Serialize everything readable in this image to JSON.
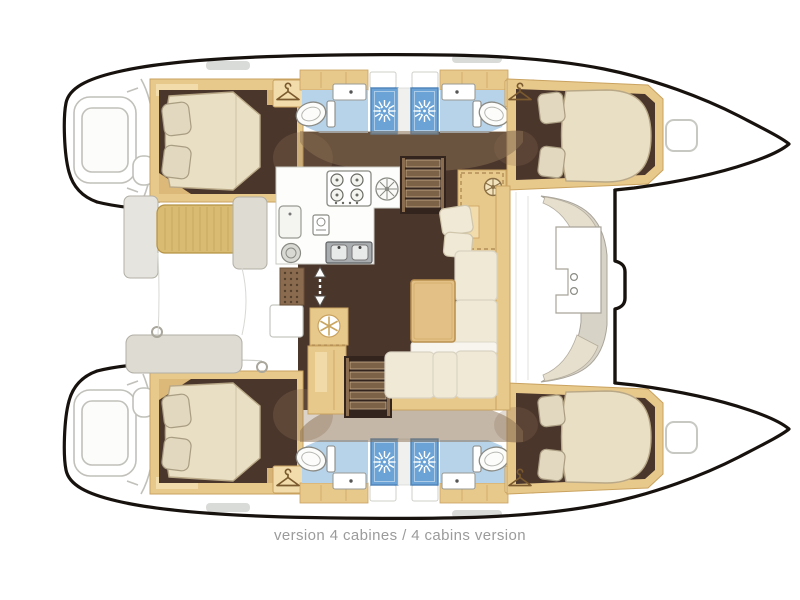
{
  "caption": "version 4 cabines / 4 cabins version",
  "plan": {
    "type": "catamaran-interior-floor-plan",
    "layout_version": "4 cabins",
    "hulls": [
      {
        "name": "port-hull",
        "rooms": [
          "aft-double-cabin",
          "aft-head-toilet-sink",
          "aft-shower",
          "fore-shower",
          "fore-head-toilet-sink",
          "fore-double-cabin"
        ]
      },
      {
        "name": "starboard-hull",
        "rooms": [
          "aft-double-cabin",
          "aft-head-toilet-sink",
          "aft-shower",
          "fore-shower",
          "fore-head-toilet-sink",
          "fore-double-cabin"
        ]
      }
    ],
    "salon": [
      "galley-counter",
      "stove-4-burners",
      "double-sink",
      "oven",
      "refrigerator-freezer",
      "companionway-stairs-port",
      "companionway-stairs-starboard",
      "chart-table",
      "dinette-sofa",
      "dinette-table",
      "entry-mat",
      "sliding-door-arrow"
    ],
    "exterior": [
      "transom-steps",
      "aft-cockpit-benches",
      "forward-cockpit-bench",
      "bow-deck-hatches"
    ]
  },
  "icons": [
    "shower-sunburst-icon",
    "clothes-hanger-icon",
    "stove-burners-icon",
    "vent-fan-icon",
    "snowflake-fridge-icon",
    "ship-wheel-icon",
    "up-down-arrow-icon"
  ],
  "colors": {
    "wood": "#e8c98c",
    "wood-edge": "#c9a25f",
    "wood-light": "#f2dcab",
    "wood-mid": "#dcb979",
    "floor": "#4b362c",
    "band": "#8a6f52",
    "blue-floor": "#b7d3ea",
    "blue-shower": "#6ba3d6",
    "shower-edge": "#4d83b8",
    "bed": "#e9dfc4",
    "bed-edge": "#b9a887",
    "pillow": "#e2d8bf",
    "cushion": "#f0e9d6",
    "cushion-back": "#f7f5ee",
    "khaki": "#d9bc72",
    "khaki-edge": "#b59243",
    "gray-bench": "#dedbd2",
    "gray-edge": "#b2afa5",
    "table": "#e3c186",
    "table-edge": "#b98f4e",
    "line": "#c1c0ba",
    "outline": "#17120e",
    "caption": "#9b9b9b"
  }
}
